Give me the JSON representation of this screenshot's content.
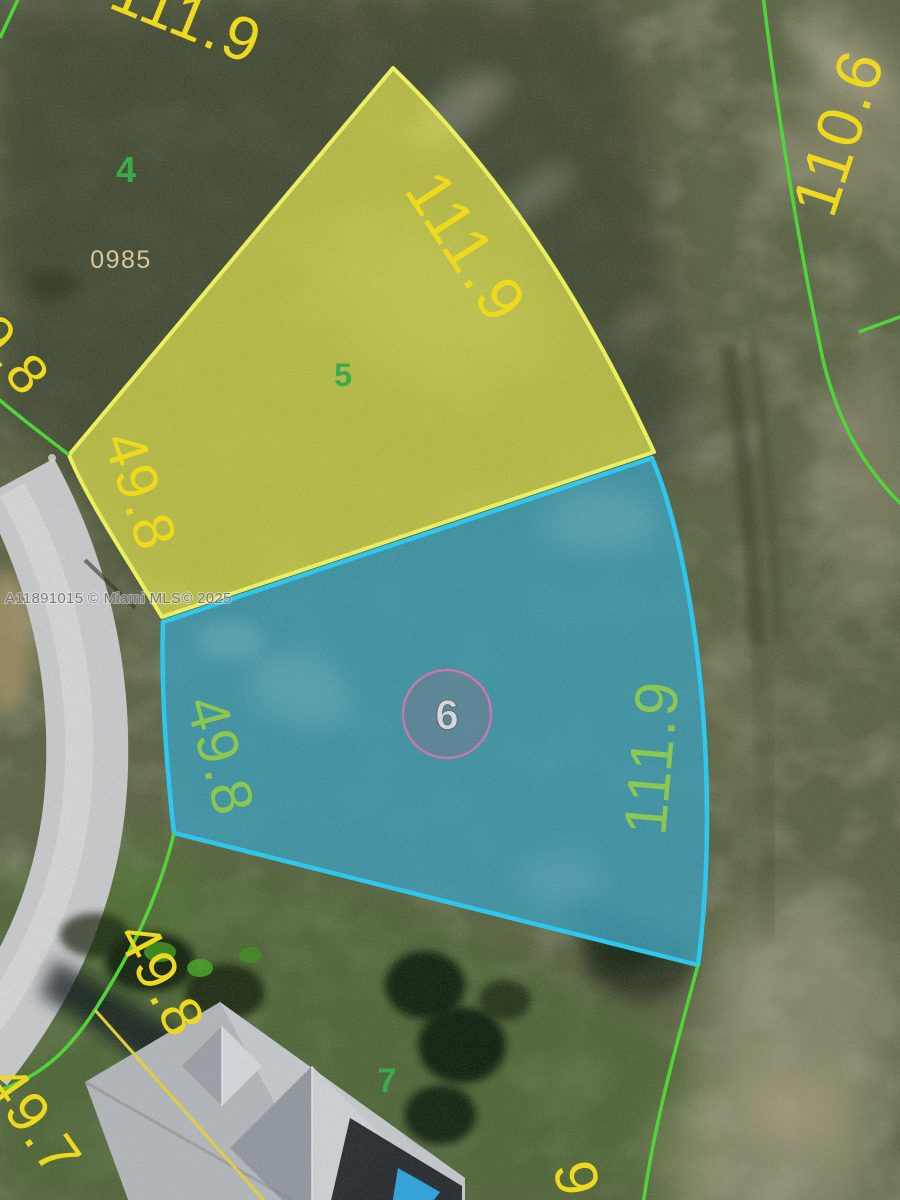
{
  "watermark": "A11891015 © Miami MLS© 2025",
  "lots": {
    "lot4": {
      "number": "4",
      "plat_code": "0985"
    },
    "lot5": {
      "number": "5",
      "highlight": "yellow",
      "rear_dimension": "111.9",
      "front_dimension": "49.8"
    },
    "lot6": {
      "number": "6",
      "highlight": "blue",
      "front_dimension": "49.8",
      "side_dimension": "111.9"
    },
    "lot7": {
      "number": "7",
      "front_dimension": "49.8"
    }
  },
  "edge_dimensions": {
    "top_partial": "111.9",
    "left_partial": "9.8",
    "right": "110.6",
    "bottom_left": "49.7",
    "bottom_right_partial": "9"
  },
  "colors": {
    "highlight_yellow_fill": "#ebee50",
    "highlight_yellow_line": "#edf35e",
    "highlight_blue_fill": "#3d9ab2",
    "highlight_blue_line": "#29c9f2",
    "lot_line_green": "#4fd636",
    "side_line_yellow": "#e3cf3f",
    "dimension_yellow": "#eed91c",
    "dimension_green": "#8cc74f",
    "lot_number_green": "#39ab4a",
    "plat_code_tan": "#d6c89d",
    "marker_circle_pink": "#c977ae"
  }
}
